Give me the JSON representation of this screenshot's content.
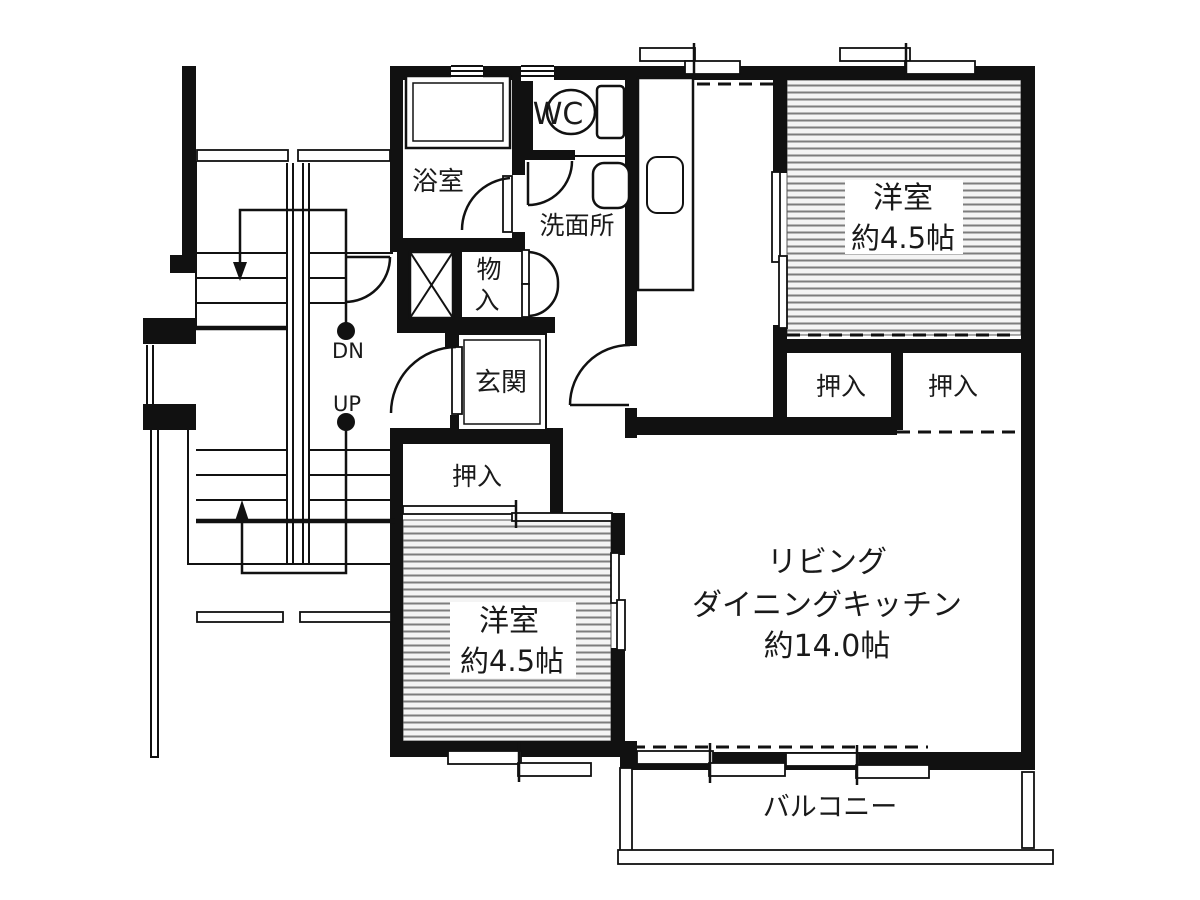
{
  "rooms": {
    "bath": "浴室",
    "wc": "WC",
    "washroom": "洗面所",
    "storage": {
      "char1": "物",
      "char2": "入"
    },
    "entrance": "玄関",
    "closet_west": "押入",
    "closet_south_left": "押入",
    "closet_south_right": "押入",
    "western_ne": {
      "name": "洋室",
      "size": "約4.5帖"
    },
    "western_sw": {
      "name": "洋室",
      "size": "約4.5帖"
    },
    "ldk": {
      "line1": "リビング",
      "line2": "ダイニングキッチン",
      "line3": "約14.0帖"
    },
    "balcony": "バルコニー"
  },
  "stairs": {
    "down_label": "DN",
    "up_label": "UP"
  },
  "colors": {
    "wall": "#111111",
    "background": "#ffffff",
    "hatch_line": "#7d7d7d"
  }
}
